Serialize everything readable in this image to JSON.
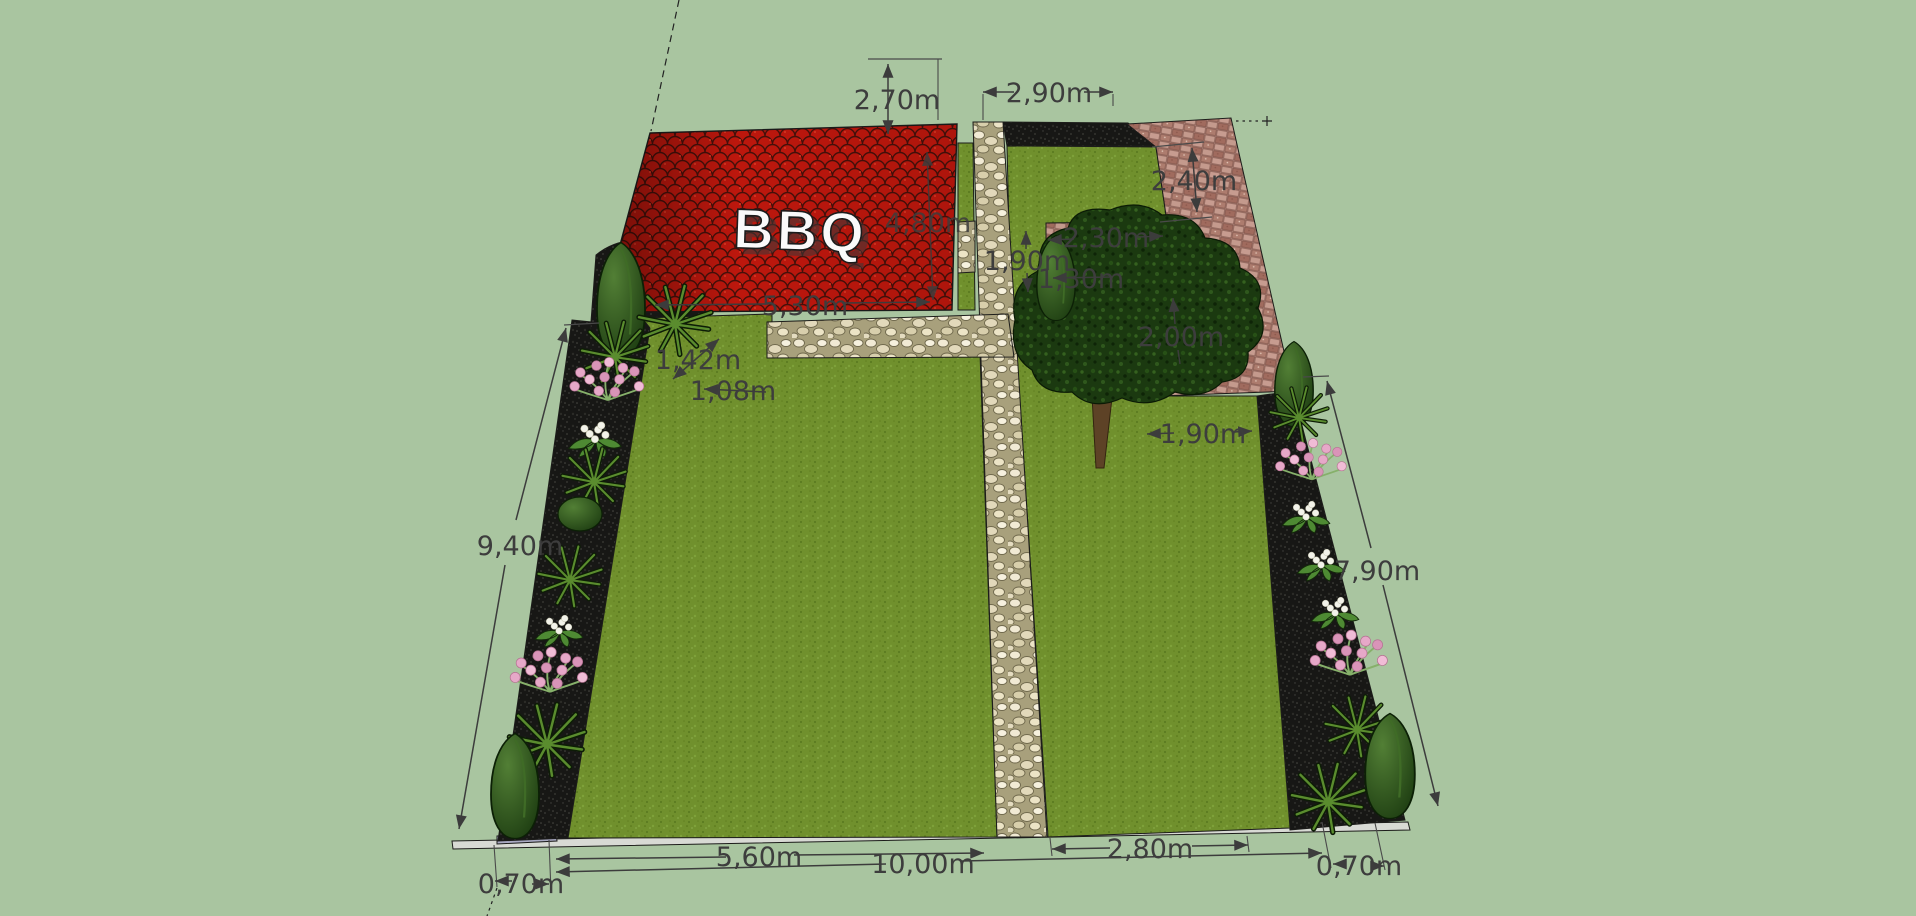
{
  "scene": {
    "bbq_label": "BBQ",
    "colors": {
      "background": "#a9c5a0",
      "roof": "#bd170d",
      "grass": "#6e8e2b",
      "gravel": "#d6cfae",
      "paving": "#b98e84",
      "soil": "#161614",
      "dimension_text": "#3d3d3d"
    },
    "dims": {
      "d270": "2,70m",
      "d290": "2,90m",
      "d240": "2,40m",
      "d230": "2,30m",
      "d190_back": "1,90m",
      "d130": "1,30m",
      "d200": "2,00m",
      "d480": "4,80m",
      "d530": "5,30m",
      "d142": "1,42m",
      "d108": "1,08m",
      "d190_mid": "1,90m",
      "d940": "9,40m",
      "d790": "7,90m",
      "d560": "5,60m",
      "d1000": "10,00m",
      "d280": "2,80m",
      "d070_left": "0,70m",
      "d070_right": "0,70m"
    }
  }
}
